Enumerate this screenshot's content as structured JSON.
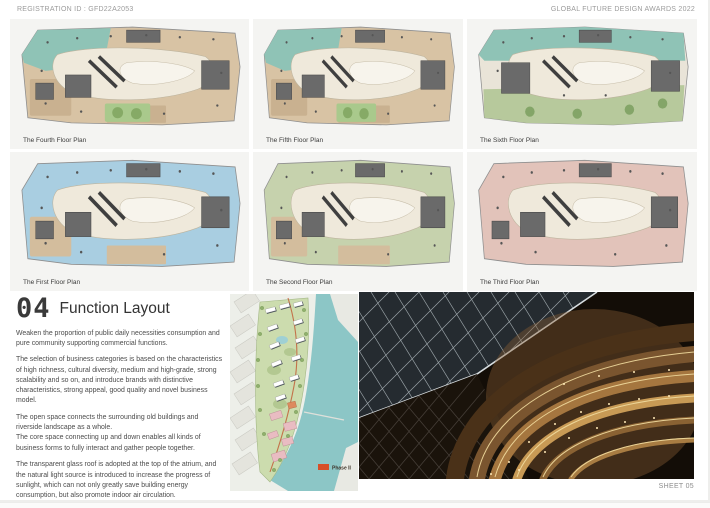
{
  "header": {
    "registration": "REGISTRATION ID :  GFD22A2053",
    "award": "GLOBAL FUTURE DESIGN AWARDS 2022"
  },
  "plans": [
    {
      "label": "The Fourth Floor Plan",
      "room_color": "#d8c3a4",
      "corner_color": "#8fc3b6",
      "top_band_color": "none",
      "bottom_band_color": "none",
      "alt_room_color": "#c9b190",
      "garden_color": "#a9c98c",
      "tree_color": "#86aa66"
    },
    {
      "label": "The Fifth Floor Plan",
      "room_color": "#d8c3a4",
      "corner_color": "#8fc3b6",
      "top_band_color": "none",
      "bottom_band_color": "none",
      "alt_room_color": "#c9b190",
      "garden_color": "#a9c98c",
      "tree_color": "#86aa66"
    },
    {
      "label": "The Sixth Floor Plan",
      "room_color": "#e9e4d8",
      "corner_color": "none",
      "top_band_color": "#8fc3b6",
      "bottom_band_color": "#b7c99c",
      "alt_room_color": "none",
      "garden_color": "none",
      "tree_color": "#84a568"
    },
    {
      "label": "The First Floor Plan",
      "room_color": "#a9cee1",
      "corner_color": "none",
      "top_band_color": "none",
      "bottom_band_color": "none",
      "alt_room_color": "#d3bd9d",
      "garden_color": "none",
      "tree_color": "none"
    },
    {
      "label": "The Second Floor Plan",
      "room_color": "#c6d2ad",
      "corner_color": "none",
      "top_band_color": "none",
      "bottom_band_color": "none",
      "alt_room_color": "#d3bd9d",
      "garden_color": "none",
      "tree_color": "none"
    },
    {
      "label": "The Third Floor Plan",
      "room_color": "#e2c3ba",
      "corner_color": "none",
      "top_band_color": "none",
      "bottom_band_color": "none",
      "alt_room_color": "none",
      "garden_color": "none",
      "tree_color": "none"
    }
  ],
  "section": {
    "number": "04",
    "title": "Function Layout",
    "paragraphs": [
      "Weaken the proportion of public daily necessities consumption and pure community supporting commercial functions.",
      "The selection of business categories is based on the characteristics of high richness, cultural diversity, medium and high-grade, strong scalability and so on, and introduce brands with distinctive characteristics, strong appeal, good quality and novel business model.",
      "The open space connects the surrounding old buildings and riverside landscape as a whole.\nThe core space connecting up and down enables all kinds of business forms to fully interact and gather people together.",
      "The transparent glass roof is adopted at the top of the atrium, and the natural light source is introduced to increase the progress of sunlight, which can not only greatly save building energy consumption, but also promote indoor air circulation."
    ]
  },
  "site_map": {
    "phase_label": "Phase II",
    "marker_color": "#d64f28"
  },
  "footer": {
    "sheet_label": "SHEET 05"
  }
}
